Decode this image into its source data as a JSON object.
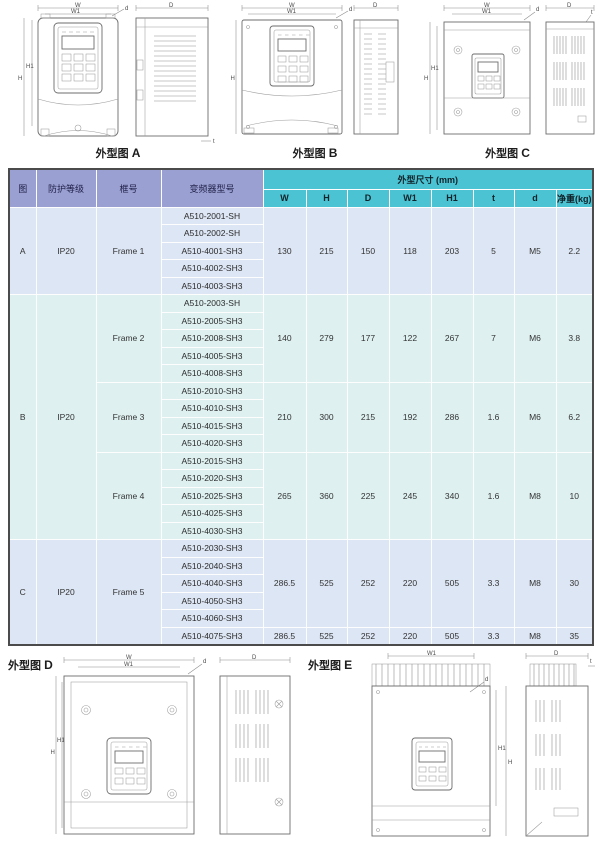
{
  "drawings": {
    "caption_prefix": "外型图",
    "figures": {
      "a": "A",
      "b": "B",
      "c": "C",
      "d": "D",
      "e": "E"
    },
    "dim_labels": {
      "w": "W",
      "w1": "W1",
      "h": "H",
      "h1": "H1",
      "depth": "D",
      "hole": "d",
      "t": "t"
    }
  },
  "table": {
    "headers": {
      "fig": "图",
      "protection": "防护等级",
      "frame": "框号",
      "model": "变频器型号",
      "dims_group": "外型尺寸 (mm)",
      "dim_cols": [
        "W",
        "H",
        "D",
        "W1",
        "H1",
        "t",
        "d",
        "净重(kg)"
      ]
    },
    "sections": [
      {
        "fig": "A",
        "protection": "IP20",
        "frames": [
          {
            "label": "Frame 1",
            "rows": 5
          }
        ],
        "dim_groups": [
          {
            "rows": 5,
            "values": [
              "130",
              "215",
              "150",
              "118",
              "203",
              "5",
              "M5",
              "2.2"
            ]
          }
        ],
        "models": [
          "A510-2001-SH",
          "A510-2002-SH",
          "A510-4001-SH3",
          "A510-4002-SH3",
          "A510-4003-SH3"
        ]
      },
      {
        "fig": "B",
        "protection": "IP20",
        "frames": [
          {
            "label": "Frame 2",
            "rows": 5
          },
          {
            "label": "Frame 3",
            "rows": 4
          },
          {
            "label": "Frame 4",
            "rows": 5
          }
        ],
        "dim_groups": [
          {
            "rows": 5,
            "values": [
              "140",
              "279",
              "177",
              "122",
              "267",
              "7",
              "M6",
              "3.8"
            ]
          },
          {
            "rows": 4,
            "values": [
              "210",
              "300",
              "215",
              "192",
              "286",
              "1.6",
              "M6",
              "6.2"
            ]
          },
          {
            "rows": 5,
            "values": [
              "265",
              "360",
              "225",
              "245",
              "340",
              "1.6",
              "M8",
              "10"
            ]
          }
        ],
        "models": [
          "A510-2003-SH",
          "A510-2005-SH3",
          "A510-2008-SH3",
          "A510-4005-SH3",
          "A510-4008-SH3",
          "A510-2010-SH3",
          "A510-4010-SH3",
          "A510-4015-SH3",
          "A510-4020-SH3",
          "A510-2015-SH3",
          "A510-2020-SH3",
          "A510-2025-SH3",
          "A510-4025-SH3",
          "A510-4030-SH3"
        ]
      },
      {
        "fig": "C",
        "protection": "IP20",
        "frames": [
          {
            "label": "Frame 5",
            "rows": 6
          }
        ],
        "dim_groups": [
          {
            "rows": 5,
            "values": [
              "286.5",
              "525",
              "252",
              "220",
              "505",
              "3.3",
              "M8",
              "30"
            ]
          },
          {
            "rows": 1,
            "values": [
              "286.5",
              "525",
              "252",
              "220",
              "505",
              "3.3",
              "M8",
              "35"
            ]
          }
        ],
        "models": [
          "A510-2030-SH3",
          "A510-2040-SH3",
          "A510-4040-SH3",
          "A510-4050-SH3",
          "A510-4060-SH3",
          "A510-4075-SH3"
        ]
      }
    ]
  }
}
